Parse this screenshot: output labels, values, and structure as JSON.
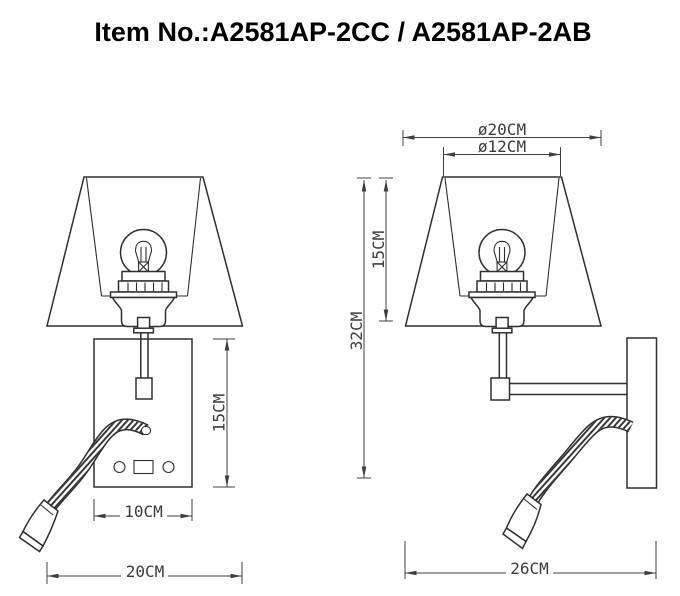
{
  "title": "Item No.:A2581AP-2CC / A2581AP-2AB",
  "dimensions": {
    "front": {
      "plate_height": "15CM",
      "plate_width": "10CM",
      "shade_width": "20CM"
    },
    "side": {
      "shade_bottom_diameter": "ø20CM",
      "shade_top_diameter": "ø12CM",
      "shade_height": "15CM",
      "overall_height": "32CM",
      "overall_depth": "26CM"
    }
  },
  "colors": {
    "drawing_line": "#2f2f2f",
    "dimension_line": "#3f3f3f",
    "background": "#ffffff",
    "title_text": "#000000"
  }
}
